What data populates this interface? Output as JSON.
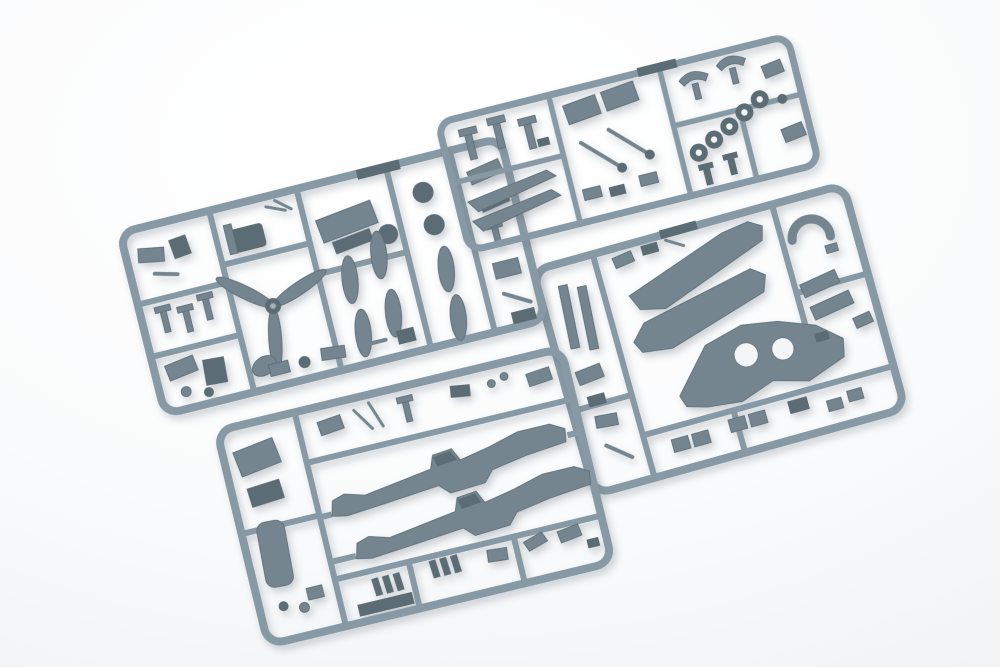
{
  "scene": {
    "description": "Overhead photograph of four blue-grey injection-moulded polystyrene sprues from a plastic scale aircraft model kit, laid overlapping on a bright seamless white surface",
    "subject": "plastic model kit sprues",
    "sprue_count": 4,
    "background": "seamless white studio surface",
    "text_visible": "none"
  },
  "colors": {
    "background": "#fafbfc",
    "background_shade": "#e7eaec",
    "runner": "#8799a4",
    "runner_dark": "#6d7f8a",
    "part": "#74858f",
    "part_dark": "#5b6c75",
    "part_light": "#a3b3bc",
    "hole": "#f3f5f6",
    "shadow": "rgba(100,112,124,0.32)"
  },
  "sprues": [
    {
      "id": "A",
      "name": "detail-parts-sprue",
      "position": "top-left",
      "tilt_deg": -14,
      "notable_parts": [
        "three-blade propeller",
        "propeller spinner",
        "drop tanks and cowl bulges",
        "two dark main wheels",
        "cockpit tub and seat",
        "undercarriage fittings",
        "small brackets"
      ]
    },
    {
      "id": "B",
      "name": "small-parts-sprue",
      "position": "top-right",
      "tilt_deg": -14,
      "notable_parts": [
        "wheel hub rings",
        "undercarriage legs",
        "horizontal stabilizer halves",
        "radiator housings",
        "wheel-bay covers",
        "tailwheel forks"
      ]
    },
    {
      "id": "C",
      "name": "fuselage-sprue",
      "position": "bottom-left",
      "tilt_deg": -13.5,
      "notable_parts": [
        "left fuselage half",
        "right fuselage half",
        "intake scoop",
        "oil cooler housing",
        "exhaust stacks",
        "rectangular base plate",
        "small levers"
      ]
    },
    {
      "id": "D",
      "name": "wing-sprue",
      "position": "right",
      "tilt_deg": -15.5,
      "notable_parts": [
        "one-piece lower wing with wheel-well openings",
        "two upper wing halves",
        "leading-edge slat strips",
        "supercharger intake",
        "flap and radiator-door sections"
      ]
    }
  ]
}
